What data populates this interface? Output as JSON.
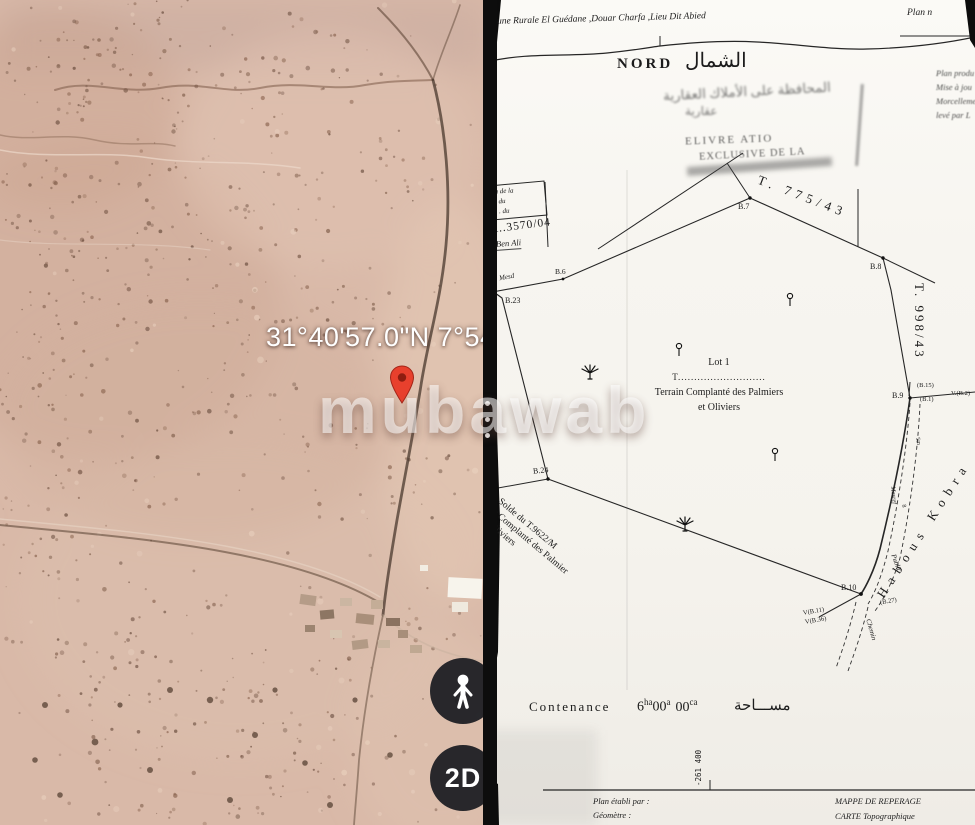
{
  "left_map": {
    "coordinates": "31°40'57.0\"N 7°54'48",
    "watermark": "mubawab",
    "mode_2d_label": "2D"
  },
  "plan": {
    "header": {
      "commune_line": "une Rurale El Guédane ,Douar Charfa ,Lieu Dit Abied",
      "plan_no": "Plan n",
      "nord": "NORD",
      "nord_ar": "الشمال",
      "margin_note_1": "Plan produ",
      "margin_note_2": "Mise à jou",
      "margin_note_3": "Morcelleme",
      "margin_note_4": "levé par L"
    },
    "stamp": {
      "ar_line1": "المحافظة على الأملاك العقارية",
      "ar_line2": "عقارية",
      "delivre": "ELIVRE          ATIO",
      "exclusive": "EXCLUSIVE DE LA"
    },
    "refbox": {
      "line1": "n de la",
      "line2": ". du",
      "line3": ". . du",
      "r_number": "R..3570/04",
      "name": "Ben Ali"
    },
    "parcels": {
      "t775": "T. 775/43",
      "t998": "T. 998/43",
      "solde_line1": "Solde du  T.9622/M",
      "solde_line2": "ie Complanté des Palmier",
      "solde_line3": "et Oliviers"
    },
    "lot": {
      "title": "Lot 1",
      "t_dotted": "T...........................",
      "desc1": "Terrain Complanté des Palmiers",
      "desc2": "et Oliviers"
    },
    "roads": {
      "habous": "Habous Kobra",
      "chemin": "Chemin",
      "public": "Public",
      "mesref": "Mesref",
      "mesd": "Mesd",
      "w1": "5m",
      "w2": "8"
    },
    "points": {
      "b6": "B.6",
      "b7": "B.7",
      "b8": "B.8",
      "b9": "B.9",
      "b10": "B.10",
      "b23": "B.23",
      "b24": "B.24",
      "b15": "(B.15)",
      "b1": "(B.1)",
      "vb2": "V.(B.2)",
      "b27": "(B.27)",
      "vb11": "V(B.11)",
      "vb36": "V(B.36)"
    },
    "contenance": {
      "label": "Contenance",
      "v1": "6",
      "u1": "ha",
      "v2": "00",
      "u2": "a",
      "v3": "00",
      "u3": "ca",
      "ar": "مســـاحة"
    },
    "grid_y": "-261 400",
    "footer": {
      "made_by": "Plan établi par :",
      "geometre": "Géomètre          :",
      "dessinateur": "Dessinateur     : informatique",
      "mappe1": "MAPPE DE REPERAGE",
      "mappe2": "CARTE Topographique"
    }
  }
}
